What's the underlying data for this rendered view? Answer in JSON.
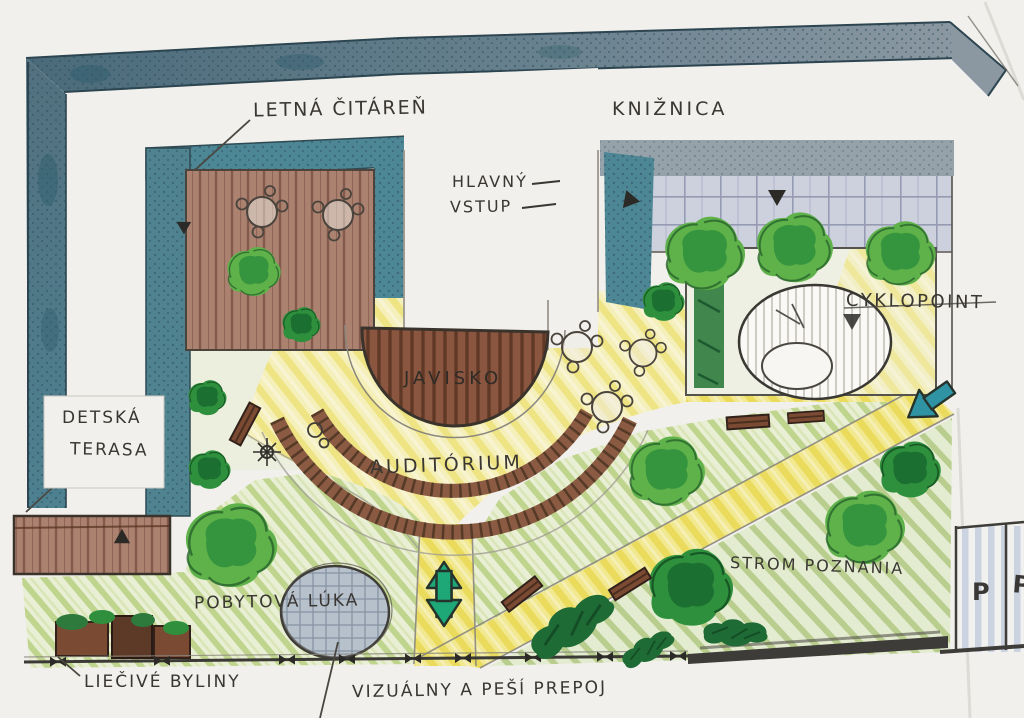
{
  "document": {
    "type": "hand-drawn landscape architecture concept plan (scanned sketch)",
    "language": "Slovak"
  },
  "labels": {
    "summer_reading_room": "LETNÁ ČITÁREŇ",
    "library": "KNIŽNICA",
    "main_entrance_line1": "HLAVNÝ",
    "main_entrance_line2": "VSTUP",
    "cyclopoint": "CYKLOPOINT",
    "stage": "JAVISKO",
    "auditorium": "AUDITÓRIUM",
    "children_terrace_line1": "DETSKÁ",
    "children_terrace_line2": "TERASA",
    "recreation_meadow": "POBYTOVÁ LÚKA",
    "tree_of_knowledge": "STROM POZNANIA",
    "medicinal_herbs": "LIEČIVÉ BYLINY",
    "visual_pedestrian_link": "VIZUÁLNY A PEŠÍ PREPOJ",
    "parking_symbol": "P"
  },
  "colors": {
    "paper": "#f1f0ec",
    "wall_blue_dark": "#4a6a7a",
    "wall_blue_light": "#8b98a2",
    "teal_accent": "#4d8694",
    "deck_brown": "#ab8170",
    "stage_brown": "#8a5640",
    "bench_brown": "#7b4a33",
    "path_yellow": "#ead94f",
    "meadow_green": "#b4cd7c",
    "tree_green": "#5fb24a",
    "tree_green_dark": "#2e8f3c",
    "shrub_dark_green": "#1f6b35",
    "arrow_green": "#1ea878",
    "arrow_teal": "#2f93a3",
    "facade_lavender": "#cdd1de",
    "circle_gray_blue": "#b7c1cc",
    "pencil_ink": "#3f3d38"
  }
}
